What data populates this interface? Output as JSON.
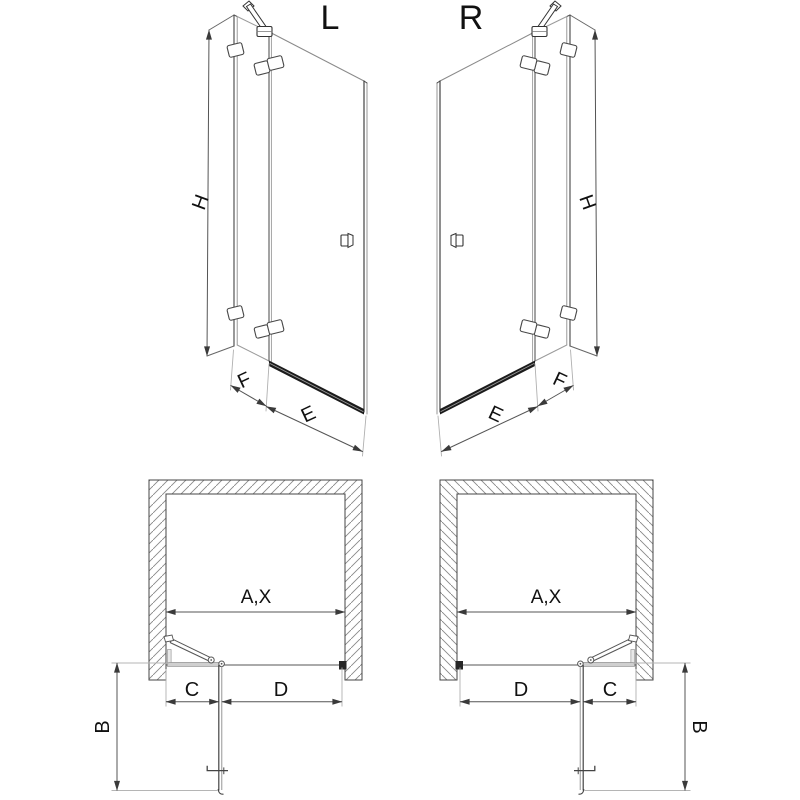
{
  "labels": {
    "left_variant": "L",
    "right_variant": "R",
    "height": "H",
    "fixed_panel_width": "F",
    "door_width": "E",
    "opening_width": "A,X",
    "hinge_side_width": "C",
    "passage_width": "D",
    "door_projection": "B"
  },
  "colors": {
    "line": "#555555",
    "outline": "#3a3a3a",
    "glass_edge": "#999999",
    "dimension": "#555555",
    "extension": "#b0b0b0",
    "bottom_bar": "#1b1b1b",
    "hatch": "#888888",
    "text": "#111111"
  }
}
